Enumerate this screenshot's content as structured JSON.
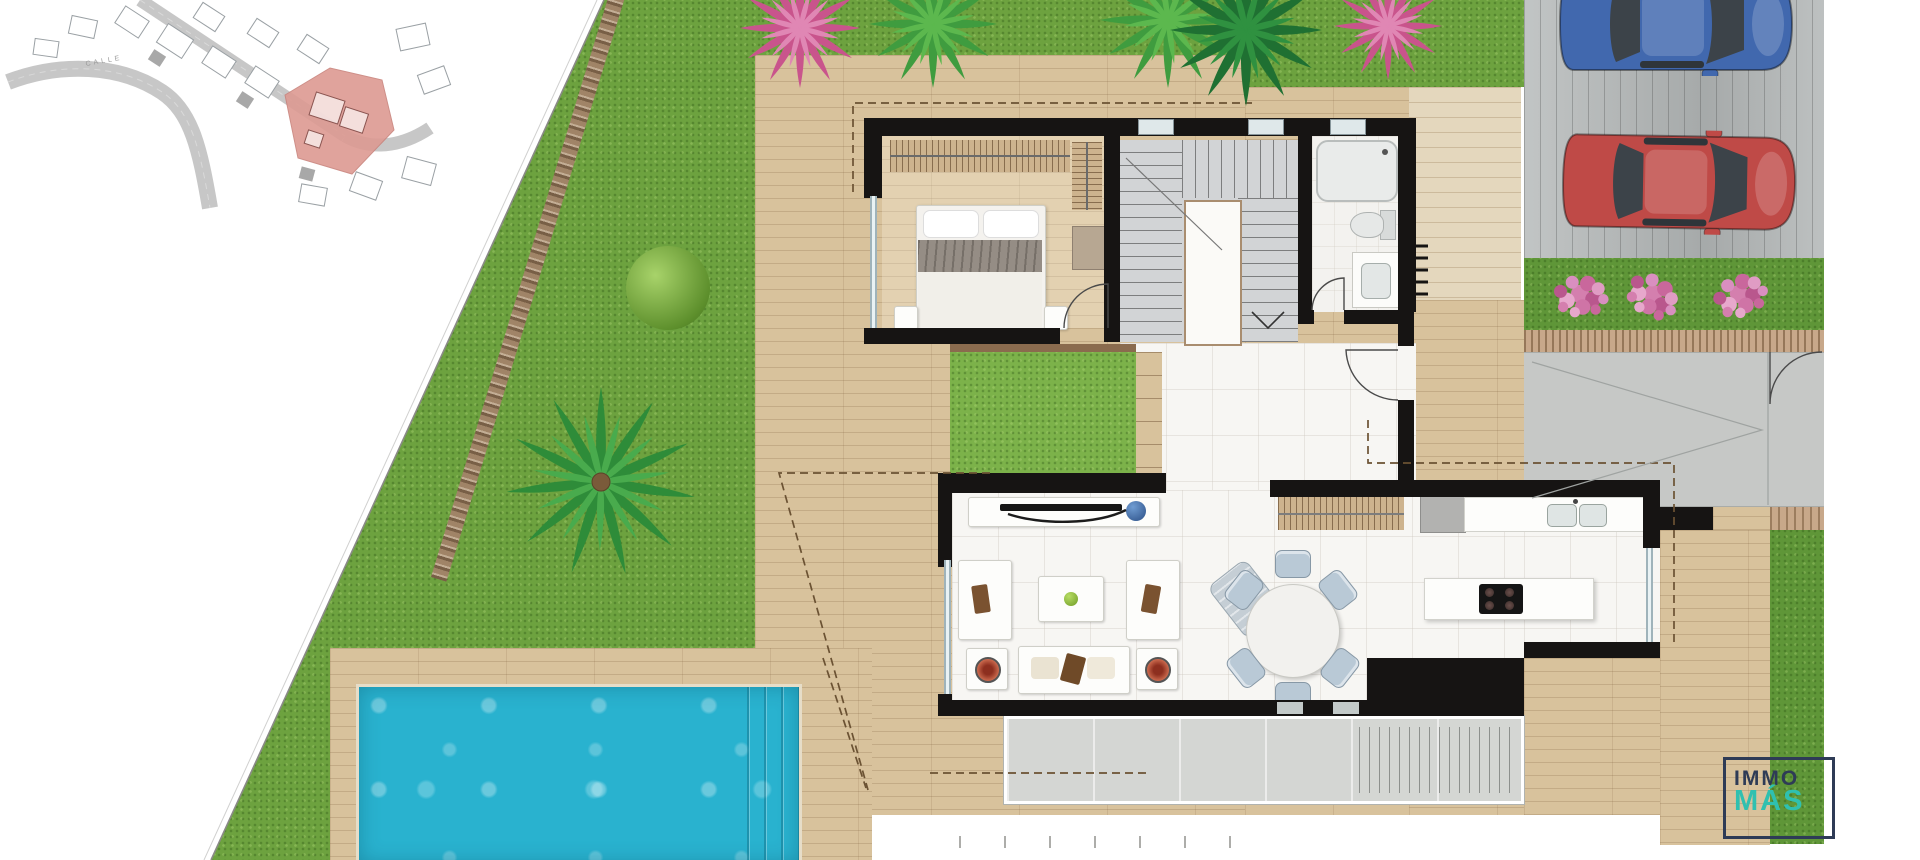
{
  "scene": {
    "type": "villa ground-floor plan rendering",
    "width": 1920,
    "height": 860
  },
  "site_plan": {
    "street_label": "CALLE",
    "highlight_color": "#dd9a92"
  },
  "logo": {
    "line1": "IMMO",
    "line2": "MÁS"
  },
  "colors": {
    "grass": "#6da23f",
    "grass_dark": "#5f9638",
    "courtyard": "#7cb24a",
    "deck": "#d8c29c",
    "deck_pale": "#e4d7bd",
    "wood_edge": "#8a6b4e",
    "wall": "#161413",
    "tile": "#f7f6f3",
    "bath": "#f3f2ef",
    "stairs": "#d2d4d6",
    "pool": "#29b2cf",
    "pool_light": "#8fe3ef",
    "concrete": "#c6c8c6",
    "porch": "#d4d6d3",
    "driveway": "#b4b8b8",
    "stone": "#c8a88a",
    "glass": "#b9c8cd",
    "car_blue": "#4168ae",
    "car_red": "#bf4a47",
    "flower_pink": "#d47fae",
    "plant_green": "#3f9c3f",
    "plant_dark": "#1f7032",
    "bush_pink": "#c9548c",
    "tan_box": "#b7a792",
    "bowl_red": "#b5432e",
    "apple": "#8fbf33",
    "chair_blue": "#b9c9d6",
    "logo_navy": "#2e3b56",
    "logo_teal": "#2fc0b0",
    "line_brown": "#6b5233",
    "road_gray": "#cfcfcf"
  }
}
